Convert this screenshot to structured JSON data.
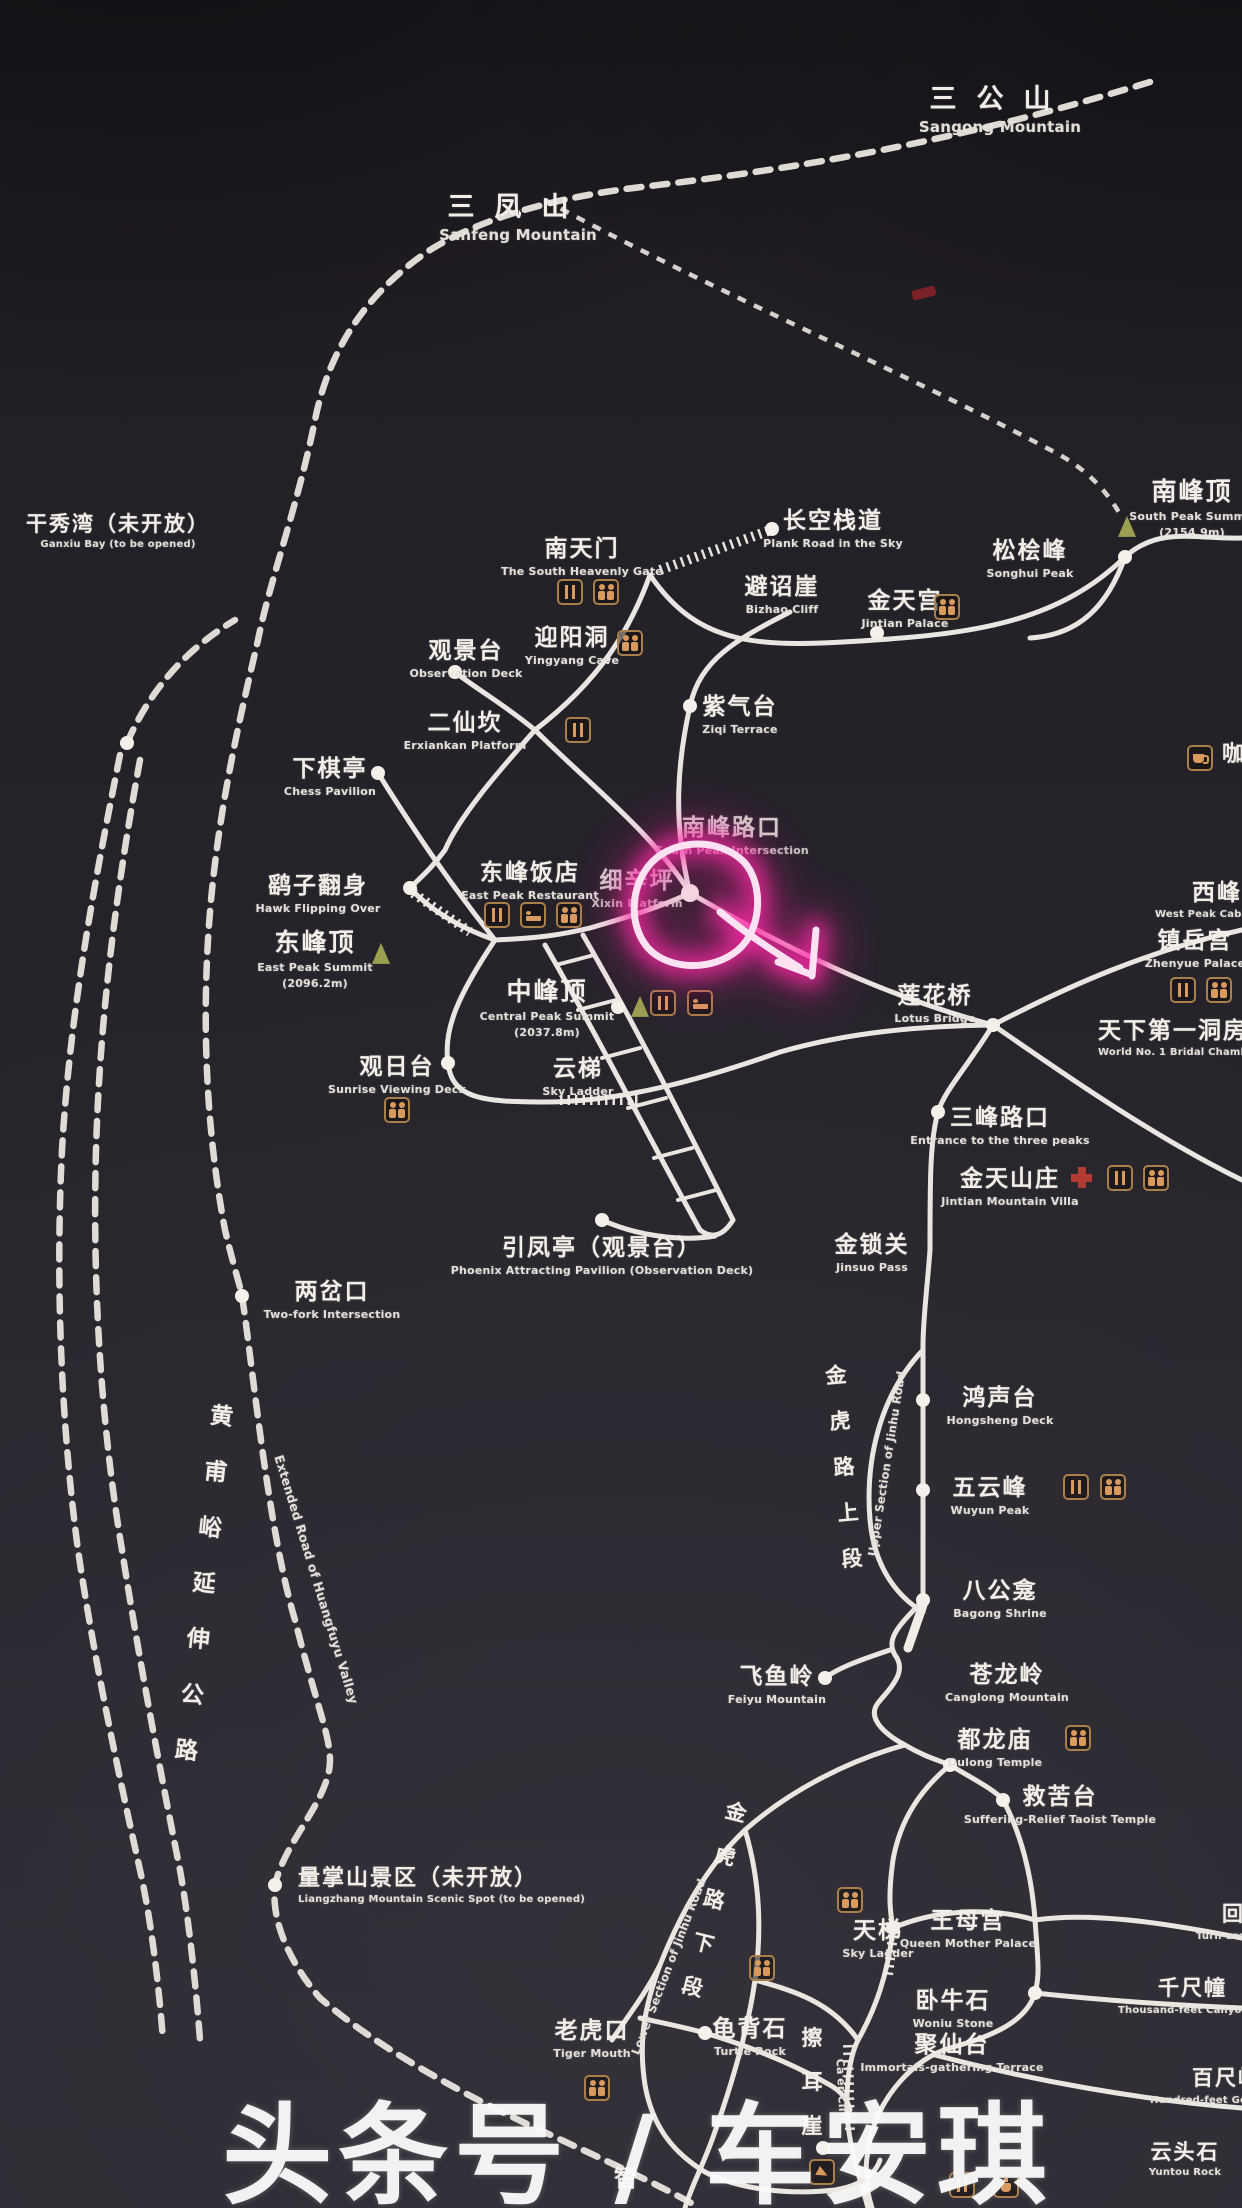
{
  "map": {
    "watermark": "头条号 / 车安琪",
    "colors": {
      "board_bg": "#262329",
      "trail": "#f0ede7",
      "icon_brown": "#a97f4b",
      "icon_glyph": "#d99a5e",
      "peak_triangle": "#9aa04f",
      "highlight_pink": "#ff25a5",
      "first_aid_red": "#b23a33"
    },
    "labels": [
      {
        "id": "sangong-mountain",
        "cn": "三公山",
        "en": "Sangong Mountain",
        "x": 1000,
        "y": 84,
        "size": 27,
        "ls": 20,
        "ensize": 15
      },
      {
        "id": "sanfeng-mountain",
        "cn": "三凤山",
        "en": "Sanfeng Mountain",
        "x": 518,
        "y": 192,
        "size": 27,
        "ls": 20,
        "ensize": 15
      },
      {
        "id": "ganxiu-bay",
        "cn": "干秀湾（未开放）",
        "en": "Ganxiu Bay (to be opened)",
        "x": 118,
        "y": 512,
        "size": 21,
        "ensize": 10
      },
      {
        "id": "south-heavenly-gate",
        "cn": "南天门",
        "en": "The South Heavenly Gate",
        "x": 582,
        "y": 536
      },
      {
        "id": "plank-road-in-the-sky",
        "cn": "长空栈道",
        "en": "Plank Road in the Sky",
        "x": 833,
        "y": 508
      },
      {
        "id": "bizhao-cliff",
        "cn": "避诏崖",
        "en": "Bizhao Cliff",
        "x": 782,
        "y": 574
      },
      {
        "id": "jintian-palace",
        "cn": "金天宫",
        "en": "Jintian Palace",
        "x": 905,
        "y": 588
      },
      {
        "id": "songhui-peak",
        "cn": "松桧峰",
        "en": "Songhui Peak",
        "x": 1030,
        "y": 538
      },
      {
        "id": "south-peak-summit",
        "cn": "南峰顶",
        "en": "South Peak Summit",
        "en2": "(2154.9m)",
        "x": 1192,
        "y": 478,
        "size": 25
      },
      {
        "id": "observation-deck",
        "cn": "观景台",
        "en": "Observation Deck",
        "x": 466,
        "y": 638
      },
      {
        "id": "yingyang-cave",
        "cn": "迎阳洞",
        "en": "Yingyang Cave",
        "x": 572,
        "y": 625
      },
      {
        "id": "ziqi-terrace",
        "cn": "紫气台",
        "en": "Ziqi Terrace",
        "x": 740,
        "y": 694
      },
      {
        "id": "erxiankan-platform",
        "cn": "二仙坎",
        "en": "Erxiankan Platform",
        "x": 465,
        "y": 710
      },
      {
        "id": "chess-pavilion",
        "cn": "下棋亭",
        "en": "Chess Pavilion",
        "x": 330,
        "y": 756
      },
      {
        "id": "south-peak-intersection",
        "cn": "南峰路口",
        "en": "South Peak Intersection",
        "x": 732,
        "y": 815,
        "dim": true
      },
      {
        "id": "xixinping",
        "cn": "细辛坪",
        "en": "Xixin Platform",
        "x": 637,
        "y": 868,
        "dim": true
      },
      {
        "id": "hawk-flipping-over",
        "cn": "鹞子翻身",
        "en": "Hawk Flipping Over",
        "x": 318,
        "y": 873
      },
      {
        "id": "east-peak-restaurant",
        "cn": "东峰饭店",
        "en": "East Peak Restaurant",
        "x": 530,
        "y": 860
      },
      {
        "id": "east-peak-summit",
        "cn": "东峰顶",
        "en": "East Peak Summit",
        "en2": "(2096.2m)",
        "x": 315,
        "y": 929,
        "size": 25
      },
      {
        "id": "central-peak-summit",
        "cn": "中峰顶",
        "en": "Central Peak Summit",
        "en2": "(2037.8m)",
        "x": 547,
        "y": 978,
        "size": 25
      },
      {
        "id": "zhenyue-palace",
        "cn": "镇岳宫",
        "en": "Zhenyue Palace",
        "x": 1195,
        "y": 928
      },
      {
        "id": "west-peak-cable",
        "cn": "西峰索道",
        "x": 1192,
        "y": 880,
        "align": "l",
        "size": 23
      },
      {
        "id": "west-peak-cable-en",
        "en": "West Peak Cable Car",
        "x": 1155,
        "y": 906,
        "align": "l",
        "ensize": 10
      },
      {
        "id": "lotus-bridge",
        "cn": "莲花桥",
        "en": "Lotus Bridge",
        "x": 935,
        "y": 983
      },
      {
        "id": "bridal-chamber",
        "cn": "天下第一洞房",
        "en": "World No. 1 Bridal Chamber",
        "x": 1098,
        "y": 1018,
        "align": "l",
        "size": 23,
        "ensize": 10
      },
      {
        "id": "sunrise-viewing-deck",
        "cn": "观日台",
        "en": "Sunrise Viewing Deck",
        "x": 397,
        "y": 1054
      },
      {
        "id": "sky-ladder-upper",
        "cn": "云梯",
        "en": "Sky Ladder",
        "x": 578,
        "y": 1056
      },
      {
        "id": "three-peaks-entrance",
        "cn": "三峰路口",
        "en": "Entrance to the three peaks",
        "x": 1000,
        "y": 1105
      },
      {
        "id": "jintian-mountain-villa",
        "cn": "金天山庄",
        "en": "Jintian Mountain Villa",
        "x": 1010,
        "y": 1166
      },
      {
        "id": "phoenix-attracting-pavilion",
        "cn": "引凤亭（观景台）",
        "en": "Phoenix Attracting Pavilion (Observation Deck)",
        "x": 602,
        "y": 1235
      },
      {
        "id": "jinsuo-pass",
        "cn": "金锁关",
        "en": "Jinsuo Pass",
        "x": 872,
        "y": 1232
      },
      {
        "id": "two-fork-intersection",
        "cn": "两岔口",
        "en": "Two-fork Intersection",
        "x": 332,
        "y": 1279
      },
      {
        "id": "huangfuyu-road",
        "cn": "黄\n甫\n峪\n延\n伸\n公\n路",
        "x": 205,
        "y": 1388,
        "vertical": true,
        "size": 23,
        "lh": 56,
        "rotate": 6
      },
      {
        "id": "huangfuyu-road-en",
        "en": "Extended Road of Huangfuyu Valley",
        "x": 318,
        "y": 1570,
        "rotate": 73,
        "ensize": 12.5
      },
      {
        "id": "jinhu-road-upper",
        "cn": "金\n虎\n路\n上\n段",
        "x": 845,
        "y": 1352,
        "vertical": true,
        "size": 21,
        "lh": 46,
        "rotate": -5
      },
      {
        "id": "jinhu-road-upper-en",
        "en": "Upper Section of Jinhu Road",
        "x": 886,
        "y": 1455,
        "rotate": -81,
        "ensize": 11.5
      },
      {
        "id": "hongsheng-deck",
        "cn": "鸿声台",
        "en": "Hongsheng Deck",
        "x": 1000,
        "y": 1385
      },
      {
        "id": "wuyun-peak",
        "cn": "五云峰",
        "en": "Wuyun Peak",
        "x": 990,
        "y": 1475
      },
      {
        "id": "bagong-shrine",
        "cn": "八公龛",
        "en": "Bagong Shrine",
        "x": 1000,
        "y": 1578
      },
      {
        "id": "feiyu-mountain",
        "cn": "飞鱼岭",
        "en": "Feiyu Mountain",
        "x": 777,
        "y": 1664
      },
      {
        "id": "canglong-mountain",
        "cn": "苍龙岭",
        "en": "Canglong Mountain",
        "x": 1007,
        "y": 1662
      },
      {
        "id": "dulong-temple",
        "cn": "都龙庙",
        "en": "Dulong Temple",
        "x": 995,
        "y": 1727
      },
      {
        "id": "suffering-relief-temple",
        "cn": "救苦台",
        "en": "Suffering-Relief Taoist Temple",
        "x": 1060,
        "y": 1784
      },
      {
        "id": "liangzhang-scenic-spot",
        "cn": "量掌山景区（未开放）",
        "en": "Liangzhang Mountain Scenic Spot (to be opened)",
        "x": 298,
        "y": 1866,
        "align": "l",
        "size": 22,
        "ensize": 10
      },
      {
        "id": "jinhu-road-lower",
        "cn": "金\n虎\n路\n下\n段",
        "x": 715,
        "y": 1788,
        "vertical": true,
        "size": 21,
        "lh": 45,
        "rotate": 14
      },
      {
        "id": "jinhu-road-lower-en",
        "en": "Lower Section of Jinhu Road",
        "x": 668,
        "y": 1958,
        "rotate": -69,
        "ensize": 11.5
      },
      {
        "id": "sky-ladder-lower",
        "cn": "天梯",
        "en": "Sky Ladder",
        "x": 878,
        "y": 1918
      },
      {
        "id": "queen-mother-palace",
        "cn": "王母宫",
        "en": "Queen Mother Palace",
        "x": 968,
        "y": 1908
      },
      {
        "id": "turnaround-stone",
        "cn": "回心石",
        "x": 1222,
        "y": 1902,
        "align": "l",
        "size": 21
      },
      {
        "id": "turnaround-stone-en",
        "en": "Turn-around Stone",
        "x": 1196,
        "y": 1928,
        "align": "l",
        "ensize": 10
      },
      {
        "id": "woniu-stone",
        "cn": "卧牛石",
        "en": "Woniu Stone",
        "x": 953,
        "y": 1988
      },
      {
        "id": "qianchichuang",
        "cn": "千尺幢",
        "x": 1158,
        "y": 1976,
        "align": "l",
        "size": 21
      },
      {
        "id": "qianchichuang-en",
        "en": "Thousand-feet Canyon",
        "x": 1118,
        "y": 2002,
        "align": "l",
        "ensize": 10
      },
      {
        "id": "juxiantai",
        "cn": "聚仙台",
        "en": "Immortals-gathering Terrace",
        "x": 952,
        "y": 2032
      },
      {
        "id": "baichixia",
        "cn": "百尺峡",
        "x": 1192,
        "y": 2066,
        "align": "l",
        "size": 21
      },
      {
        "id": "baichixia-en",
        "en": "Hundred-feet Gorge",
        "x": 1150,
        "y": 2092,
        "align": "l",
        "ensize": 10
      },
      {
        "id": "tiger-mouth",
        "cn": "老虎口",
        "en": "Tiger Mouth",
        "x": 592,
        "y": 2018
      },
      {
        "id": "turtle-rock",
        "cn": "龟背石",
        "en": "Turtle Rock",
        "x": 750,
        "y": 2016
      },
      {
        "id": "caer-cliff",
        "cn": "擦\n耳\n崖",
        "x": 813,
        "y": 2016,
        "vertical": true,
        "size": 21,
        "lh": 44
      },
      {
        "id": "caer-cliff-en",
        "en": "Ca'er Cliff",
        "x": 843,
        "y": 2082,
        "rotate": 87,
        "ensize": 11
      },
      {
        "id": "yuntou-rock",
        "cn": "云头石",
        "en": "Yuntou Rock",
        "x": 1185,
        "y": 2140,
        "size": 21,
        "ensize": 10
      },
      {
        "id": "zhiqu-road-char",
        "cn": "智",
        "x": 627,
        "y": 2165,
        "size": 24
      },
      {
        "id": "coffee-house",
        "cn": "咖啡屋",
        "x": 1222,
        "y": 742,
        "align": "l",
        "size": 22
      }
    ],
    "icons": [
      {
        "type": "rest",
        "x": 570,
        "y": 592
      },
      {
        "type": "wc",
        "x": 606,
        "y": 592
      },
      {
        "type": "wc",
        "x": 947,
        "y": 607
      },
      {
        "type": "wc",
        "x": 630,
        "y": 643
      },
      {
        "type": "rest",
        "x": 578,
        "y": 730
      },
      {
        "type": "rest",
        "x": 497,
        "y": 915
      },
      {
        "type": "bed",
        "x": 533,
        "y": 915
      },
      {
        "type": "wc",
        "x": 569,
        "y": 915
      },
      {
        "type": "rest",
        "x": 663,
        "y": 1003
      },
      {
        "type": "bed",
        "x": 700,
        "y": 1003
      },
      {
        "type": "rest",
        "x": 1183,
        "y": 990
      },
      {
        "type": "wc",
        "x": 1219,
        "y": 990
      },
      {
        "type": "wc",
        "x": 397,
        "y": 1110
      },
      {
        "type": "cross",
        "x": 1082,
        "y": 1178
      },
      {
        "type": "rest",
        "x": 1120,
        "y": 1178
      },
      {
        "type": "wc",
        "x": 1156,
        "y": 1178
      },
      {
        "type": "rest",
        "x": 1076,
        "y": 1487
      },
      {
        "type": "wc",
        "x": 1113,
        "y": 1487
      },
      {
        "type": "wc",
        "x": 1078,
        "y": 1738
      },
      {
        "type": "wc",
        "x": 850,
        "y": 1900
      },
      {
        "type": "wc",
        "x": 762,
        "y": 1968
      },
      {
        "type": "wc",
        "x": 597,
        "y": 2088
      },
      {
        "type": "cup",
        "x": 1200,
        "y": 758
      },
      {
        "type": "arr",
        "x": 822,
        "y": 2172
      },
      {
        "type": "rest",
        "x": 962,
        "y": 2185
      },
      {
        "type": "kettle",
        "x": 1006,
        "y": 2185
      }
    ],
    "dots": [
      {
        "x": 772,
        "y": 529
      },
      {
        "x": 877,
        "y": 633
      },
      {
        "x": 1125,
        "y": 557
      },
      {
        "x": 690,
        "y": 706
      },
      {
        "x": 455,
        "y": 672
      },
      {
        "x": 378,
        "y": 773
      },
      {
        "x": 410,
        "y": 888
      },
      {
        "x": 690,
        "y": 893,
        "r": 9
      },
      {
        "x": 618,
        "y": 1007
      },
      {
        "x": 448,
        "y": 1063
      },
      {
        "x": 993,
        "y": 1025
      },
      {
        "x": 938,
        "y": 1112
      },
      {
        "x": 602,
        "y": 1220
      },
      {
        "x": 242,
        "y": 1296
      },
      {
        "x": 127,
        "y": 743
      },
      {
        "x": 275,
        "y": 1885
      },
      {
        "x": 923,
        "y": 1400
      },
      {
        "x": 923,
        "y": 1490
      },
      {
        "x": 923,
        "y": 1600
      },
      {
        "x": 825,
        "y": 1678
      },
      {
        "x": 950,
        "y": 1765
      },
      {
        "x": 1003,
        "y": 1800
      },
      {
        "x": 893,
        "y": 1928
      },
      {
        "x": 1035,
        "y": 1993
      },
      {
        "x": 705,
        "y": 2033
      },
      {
        "x": 823,
        "y": 2148
      }
    ],
    "triangles": [
      {
        "x": 1127,
        "y": 528
      },
      {
        "x": 381,
        "y": 955
      },
      {
        "x": 640,
        "y": 1008
      }
    ]
  }
}
